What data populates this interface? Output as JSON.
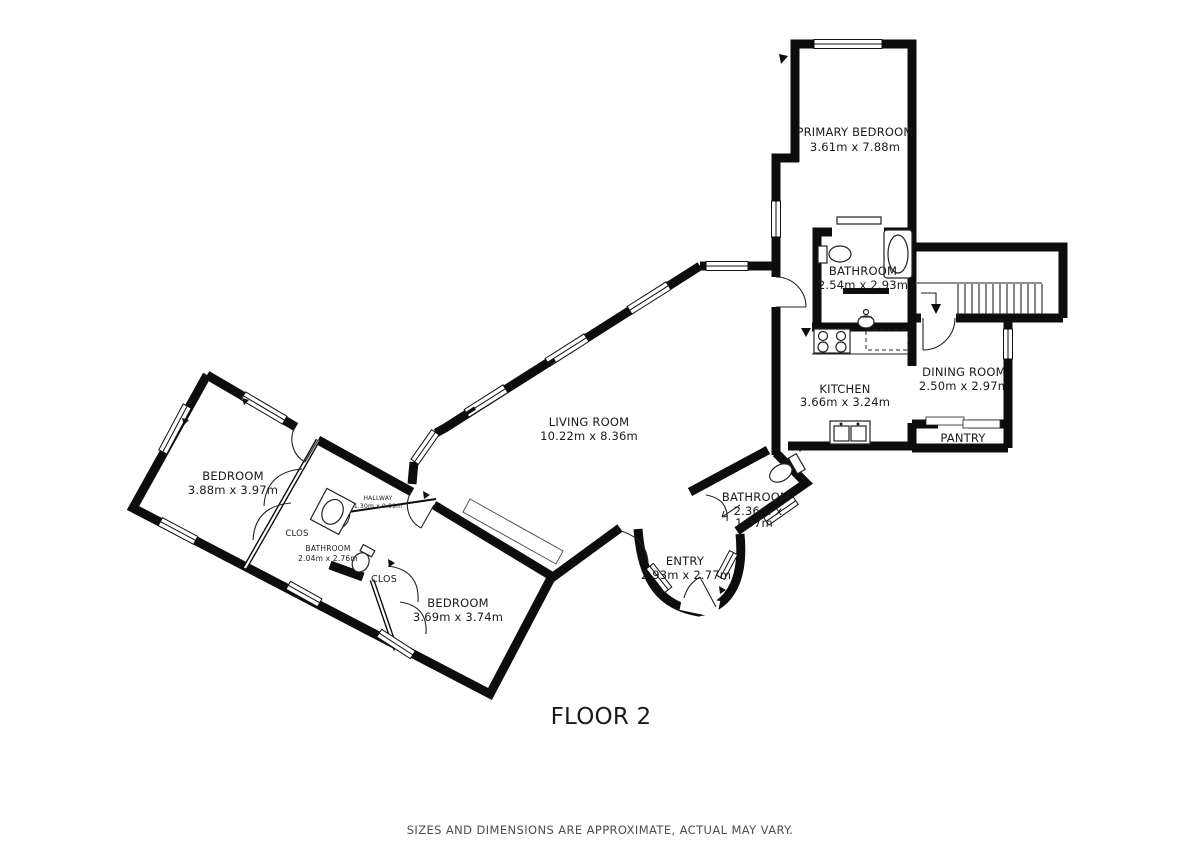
{
  "floor": {
    "title": "FLOOR 2"
  },
  "footer": {
    "disclaimer": "SIZES AND DIMENSIONS ARE APPROXIMATE, ACTUAL MAY VARY."
  },
  "colors": {
    "wall": "#0d0d0d",
    "text": "#1a1a1a",
    "muted": "#4d4d4d",
    "background": "#ffffff"
  },
  "rooms": {
    "primary_bedroom": {
      "name": "PRIMARY BEDROOM",
      "dims": "3.61m x 7.88m"
    },
    "bathroom_primary": {
      "name": "BATHROOM",
      "dims": "2.54m x 2.93m"
    },
    "kitchen": {
      "name": "KITCHEN",
      "dims": "3.66m x 3.24m"
    },
    "dining_room": {
      "name": "DINING ROOM",
      "dims": "2.50m x 2.97m"
    },
    "pantry": {
      "name": "PANTRY"
    },
    "living_room": {
      "name": "LIVING ROOM",
      "dims": "10.22m x 8.36m"
    },
    "entry": {
      "name": "ENTRY",
      "dims": "2.93m x 2.77m"
    },
    "bathroom_entry": {
      "name": "BATHROOM",
      "dims_line1": "2.36m x",
      "dims_line2": "1.37m"
    },
    "bedroom_west": {
      "name": "BEDROOM",
      "dims": "3.88m x 3.97m"
    },
    "hallway": {
      "name": "HALLWAY",
      "dims": "1.30m x 0.99m"
    },
    "bathroom_west": {
      "name": "BATHROOM",
      "dims": "2.04m x 2.76m"
    },
    "closet_a": {
      "name": "CLOS"
    },
    "closet_b": {
      "name": "CLOS"
    },
    "bedroom_south": {
      "name": "BEDROOM",
      "dims": "3.69m x 3.74m"
    }
  }
}
